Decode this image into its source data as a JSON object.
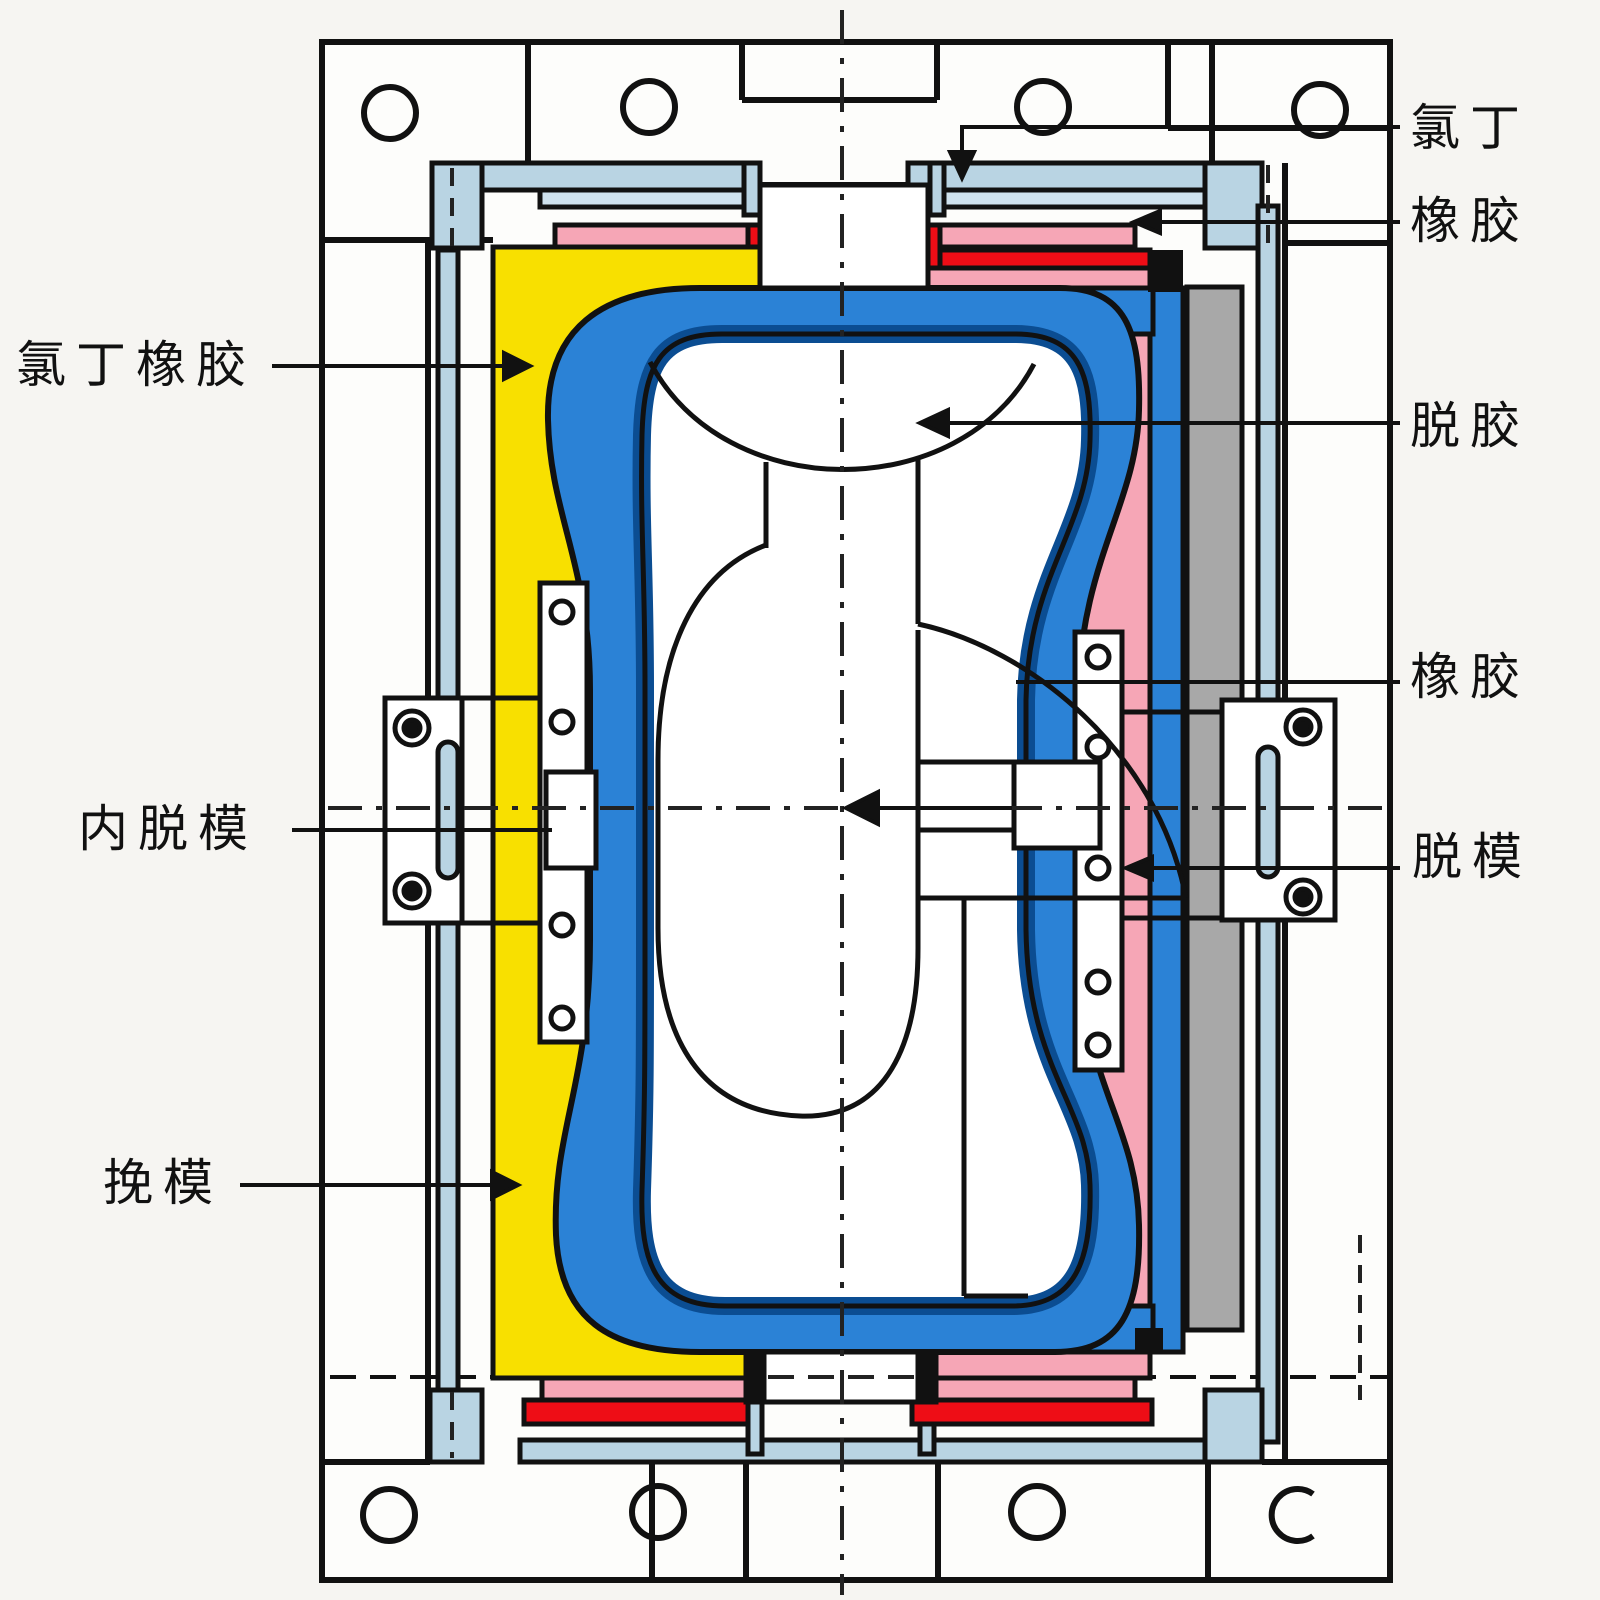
{
  "diagram": {
    "type": "engineering cross-section of a rubber bladder mold",
    "labels": {
      "chloroprene_top": "氯丁",
      "rubber_top": "橡胶",
      "chloroprene_rubber_left": "氯丁橡胶",
      "degum_right": "脱胶",
      "rubber_mid_right": "橡胶",
      "inner_demold_left": "内脱模",
      "demold_right": "脱模",
      "pull_mold_left": "挽模"
    },
    "colors": {
      "yellow_mold": "#f8e000",
      "pink_region": "#f6a6b6",
      "red_layer": "#ee0d16",
      "blue_bladder": "#2b82d6",
      "dark_blue_layer": "#0b4d92",
      "light_blue_plate": "#b9d4e3",
      "gray_plate": "#a8a8a8",
      "line": "#111111",
      "frame_fill": "#fdfdfb",
      "background": "#f6f5f2"
    }
  }
}
